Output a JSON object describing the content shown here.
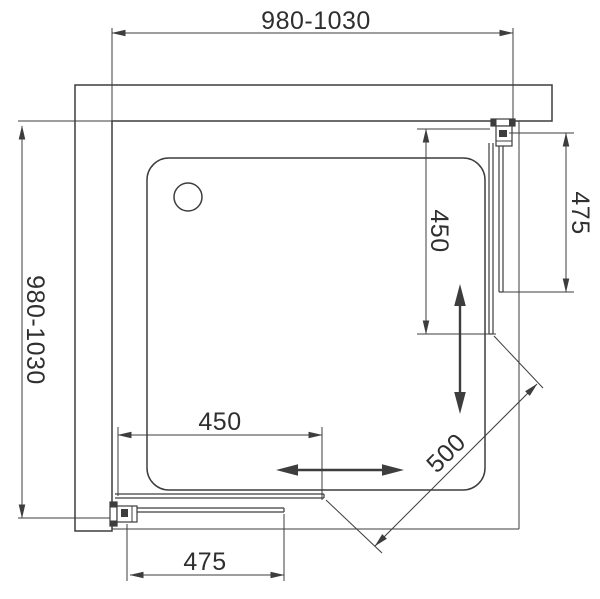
{
  "drawing": {
    "type": "technical-plan",
    "subject": "Square corner shower enclosure with sliding doors — top view dimension drawing",
    "colors": {
      "line": "#3d3d3d",
      "text": "#2f2f2f",
      "background": "#ffffff"
    },
    "dimensions": {
      "top_width": "980-1030",
      "left_depth": "980-1030",
      "right_fixed_panel": "475",
      "right_door_opening": "450",
      "bottom_door_opening": "450",
      "bottom_fixed_panel": "475",
      "diagonal_entry": "500"
    }
  }
}
